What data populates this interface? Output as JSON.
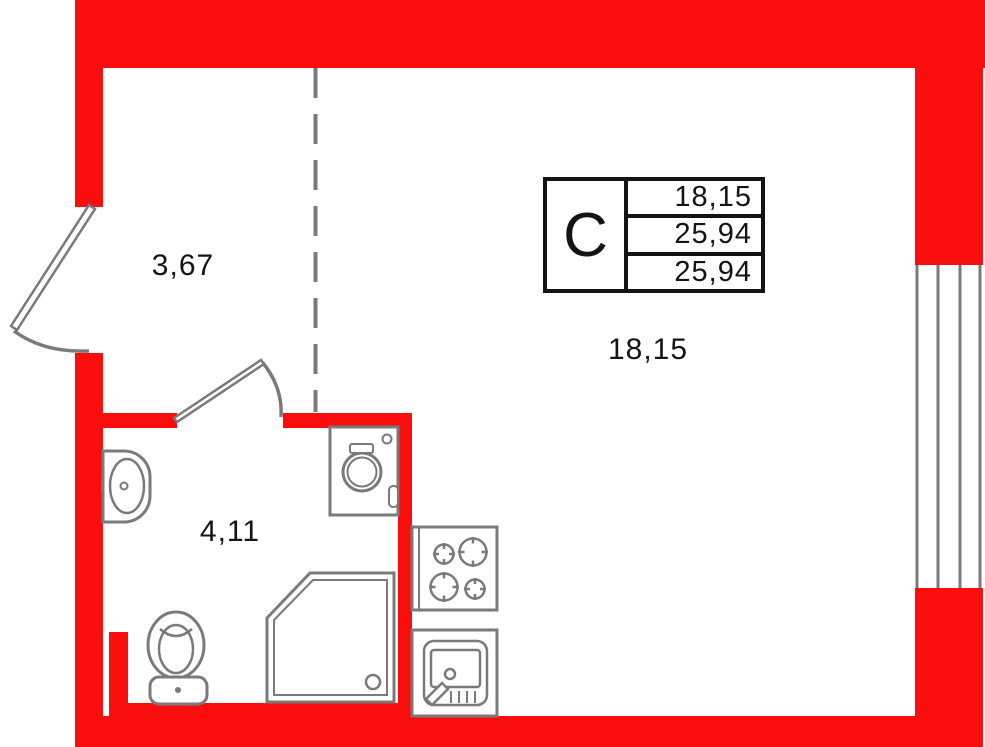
{
  "plan_title": "studio-apartment-floor-plan",
  "colors": {
    "wall": "#f90d0d",
    "fixture": "#7a7a7a",
    "ink": "#141414",
    "background": "#ffffff"
  },
  "rooms": [
    {
      "id": "hallway",
      "area_label": "3,67"
    },
    {
      "id": "living-kitchen",
      "area_label": "18,15"
    },
    {
      "id": "bathroom",
      "area_label": "4,11"
    }
  ],
  "stamp": {
    "section_letter": "C",
    "rows": [
      "18,15",
      "25,94",
      "25,94"
    ]
  },
  "fixtures": [
    "entrance-door-icon",
    "interior-door-icon",
    "window-icon",
    "room-divider-dashed-line",
    "bathroom-sink-icon",
    "toilet-icon",
    "shower-icon",
    "washing-machine-icon",
    "stove-icon",
    "kitchen-sink-icon"
  ]
}
